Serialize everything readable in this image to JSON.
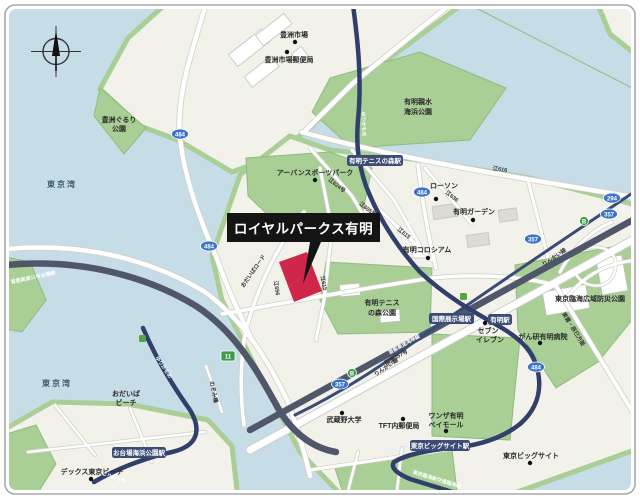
{
  "colors": {
    "water": "#c6dde8",
    "land": "#f2f1ea",
    "park": "#a9ce96",
    "road": "#ffffff",
    "rail_navy": "#31406b",
    "expressway": "#50576a",
    "site_red": "#ce2749",
    "callout_bg": "#141414",
    "station_badge": "#3c4c74",
    "route_shield_blue": "#3c72c8",
    "route_shield_green": "#3f9b4a"
  },
  "callout": {
    "label": "ロイヤルパークス有明"
  },
  "sea": {
    "tokyo_bay": "東京湾"
  },
  "places": {
    "toyosu_market": "豊洲市場",
    "toyosu_post_office": "豊洲市場郵便局",
    "gururi_l1": "豊洲ぐるり",
    "gururi_l2": "公園",
    "shinsui_l1": "有明親水",
    "shinsui_l2": "海浜公園",
    "urban_sports": "アーバンスポーツパーク",
    "lawson": "ローソン",
    "ariake_garden": "有明ガーデン",
    "coliseum": "有明コロシアム",
    "tennis_l1": "有明テニス",
    "tennis_l2": "の森公園",
    "bosai_park": "東京臨海広域防災公園",
    "seven_l1": "セブン",
    "seven_l2": "イレブン",
    "ganken": "がん研有明病院",
    "wanza_l1": "ワンザ有明",
    "wanza_l2": "ベイモール",
    "tft": "TFT内郵便局",
    "musashino": "武蔵野大学",
    "big_sight": "東京ビッグサイト",
    "decks": "デックス東京ビーチ",
    "odaiba_beach_l1": "おだいば",
    "odaiba_beach_l2": "ビーチ",
    "nozomi": "のぞみ橋"
  },
  "stations": {
    "ariake_tennis_no_mori": "有明テニスの森駅",
    "kokusai_tenjijo": "国際展示場駅",
    "ariake": "有明駅",
    "tokyo_big_sight": "東京ビッグサイト駅",
    "odaiba_kaihin_koen": "お台場海浜公園駅"
  },
  "transit": {
    "yurikamome": "ゆりかもめ",
    "rinkai": "りんかい線",
    "daiba_line": "首都高速11号台場線",
    "wangan": "首都高速湾岸線",
    "route357": "国道357号",
    "rinkai_shinkotsu": "東京臨海新交通臨海線",
    "shinonome": "東雲・辰巳方面"
  },
  "road_numbers": {
    "e624": "江624号",
    "e605": "江605号",
    "e616": "江616",
    "e636": "江636",
    "e615": "江615",
    "e656": "江656",
    "odaiba_road": "おだいばロード"
  },
  "shields": {
    "r484": "484",
    "r357": "357",
    "r294": "294",
    "r11": "11",
    "b_route": "B"
  }
}
